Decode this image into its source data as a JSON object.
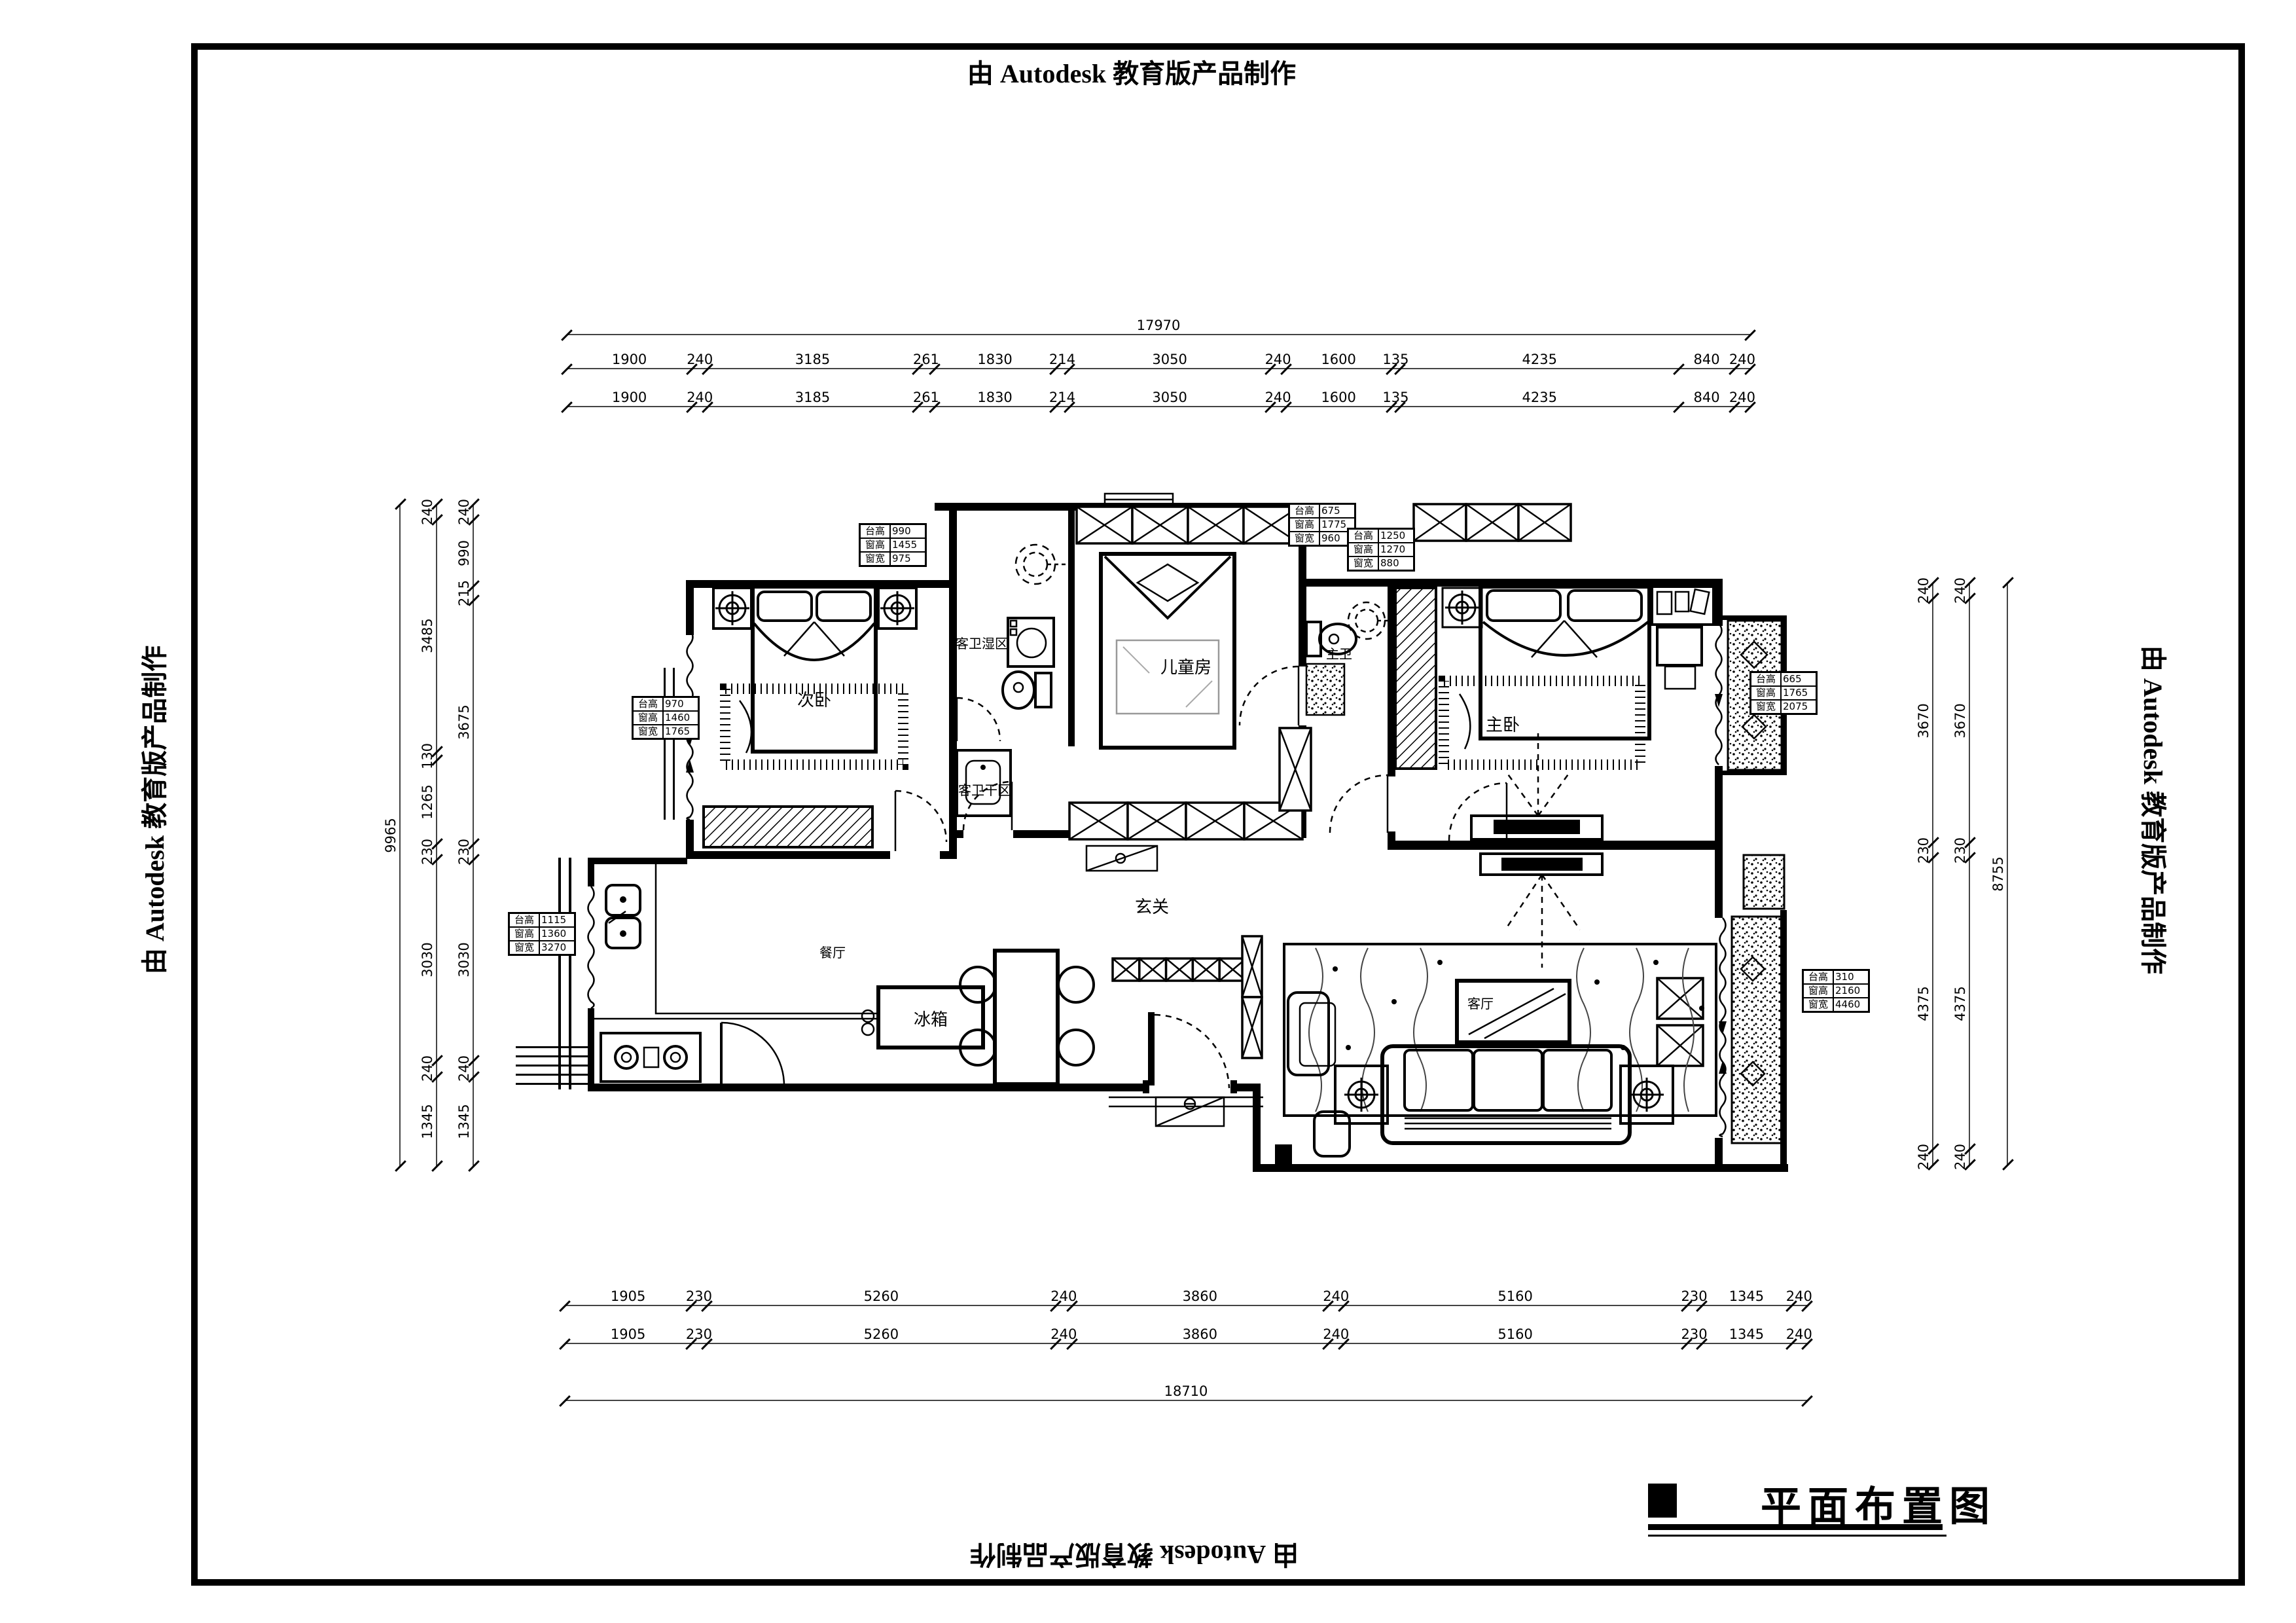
{
  "watermark": {
    "text": "由 Autodesk 教育版产品制作"
  },
  "title_block": {
    "title": "平面布置图"
  },
  "rooms": {
    "secondary_bedroom": "次卧",
    "guest_bath_wet": "客卫湿区",
    "guest_bath_dry": "客卫干区",
    "kids_room": "儿童房",
    "master_bath": "主卫",
    "master_bedroom": "主卧",
    "entry": "玄关",
    "dining": "餐厅",
    "living": "客厅",
    "fridge": "冰箱"
  },
  "annotation_boxes": [
    {
      "rows": [
        {
          "label": "台高",
          "value": "990"
        },
        {
          "label": "窗高",
          "value": "1455"
        },
        {
          "label": "窗宽",
          "value": "975"
        }
      ]
    },
    {
      "rows": [
        {
          "label": "台高",
          "value": "675"
        },
        {
          "label": "窗高",
          "value": "1775"
        },
        {
          "label": "窗宽",
          "value": "960"
        }
      ]
    },
    {
      "rows": [
        {
          "label": "台高",
          "value": "1250"
        },
        {
          "label": "窗高",
          "value": "1270"
        },
        {
          "label": "窗宽",
          "value": "880"
        }
      ]
    },
    {
      "rows": [
        {
          "label": "台高",
          "value": "1115"
        },
        {
          "label": "窗高",
          "value": "1360"
        },
        {
          "label": "窗宽",
          "value": "3270"
        }
      ]
    },
    {
      "rows": [
        {
          "label": "台高",
          "value": "970"
        },
        {
          "label": "窗高",
          "value": "1460"
        },
        {
          "label": "窗宽",
          "value": "1765"
        }
      ]
    },
    {
      "rows": [
        {
          "label": "台高",
          "value": "665"
        },
        {
          "label": "窗高",
          "value": "1765"
        },
        {
          "label": "窗宽",
          "value": "2075"
        }
      ]
    },
    {
      "rows": [
        {
          "label": "台高",
          "value": "310"
        },
        {
          "label": "窗高",
          "value": "2160"
        },
        {
          "label": "窗宽",
          "value": "4460"
        }
      ]
    }
  ],
  "dimensions": {
    "top_total": [
      17970
    ],
    "top_row1": [
      1900,
      240,
      3185,
      261,
      1830,
      214,
      3050,
      240,
      1600,
      135,
      4235,
      840,
      240
    ],
    "top_row2": [
      1900,
      240,
      3185,
      261,
      1830,
      214,
      3050,
      240,
      1600,
      135,
      4235,
      840,
      240
    ],
    "left_total": [
      9965
    ],
    "left_outer": [
      240,
      3485,
      130,
      1265,
      230,
      3030,
      240,
      1345
    ],
    "left_inner": [
      240,
      990,
      215,
      3675,
      230,
      3030,
      240,
      1345
    ],
    "right_row1": [
      240,
      3670,
      230,
      4375,
      240
    ],
    "right_row2": [
      240,
      3670,
      230,
      4375,
      240
    ],
    "right_total": [
      8755
    ],
    "bottom_row1": [
      1905,
      230,
      5260,
      240,
      3860,
      240,
      5160,
      230,
      1345,
      240
    ],
    "bottom_row2": [
      1905,
      230,
      5260,
      240,
      3860,
      240,
      5160,
      230,
      1345,
      240
    ],
    "bottom_total": [
      18710
    ]
  }
}
